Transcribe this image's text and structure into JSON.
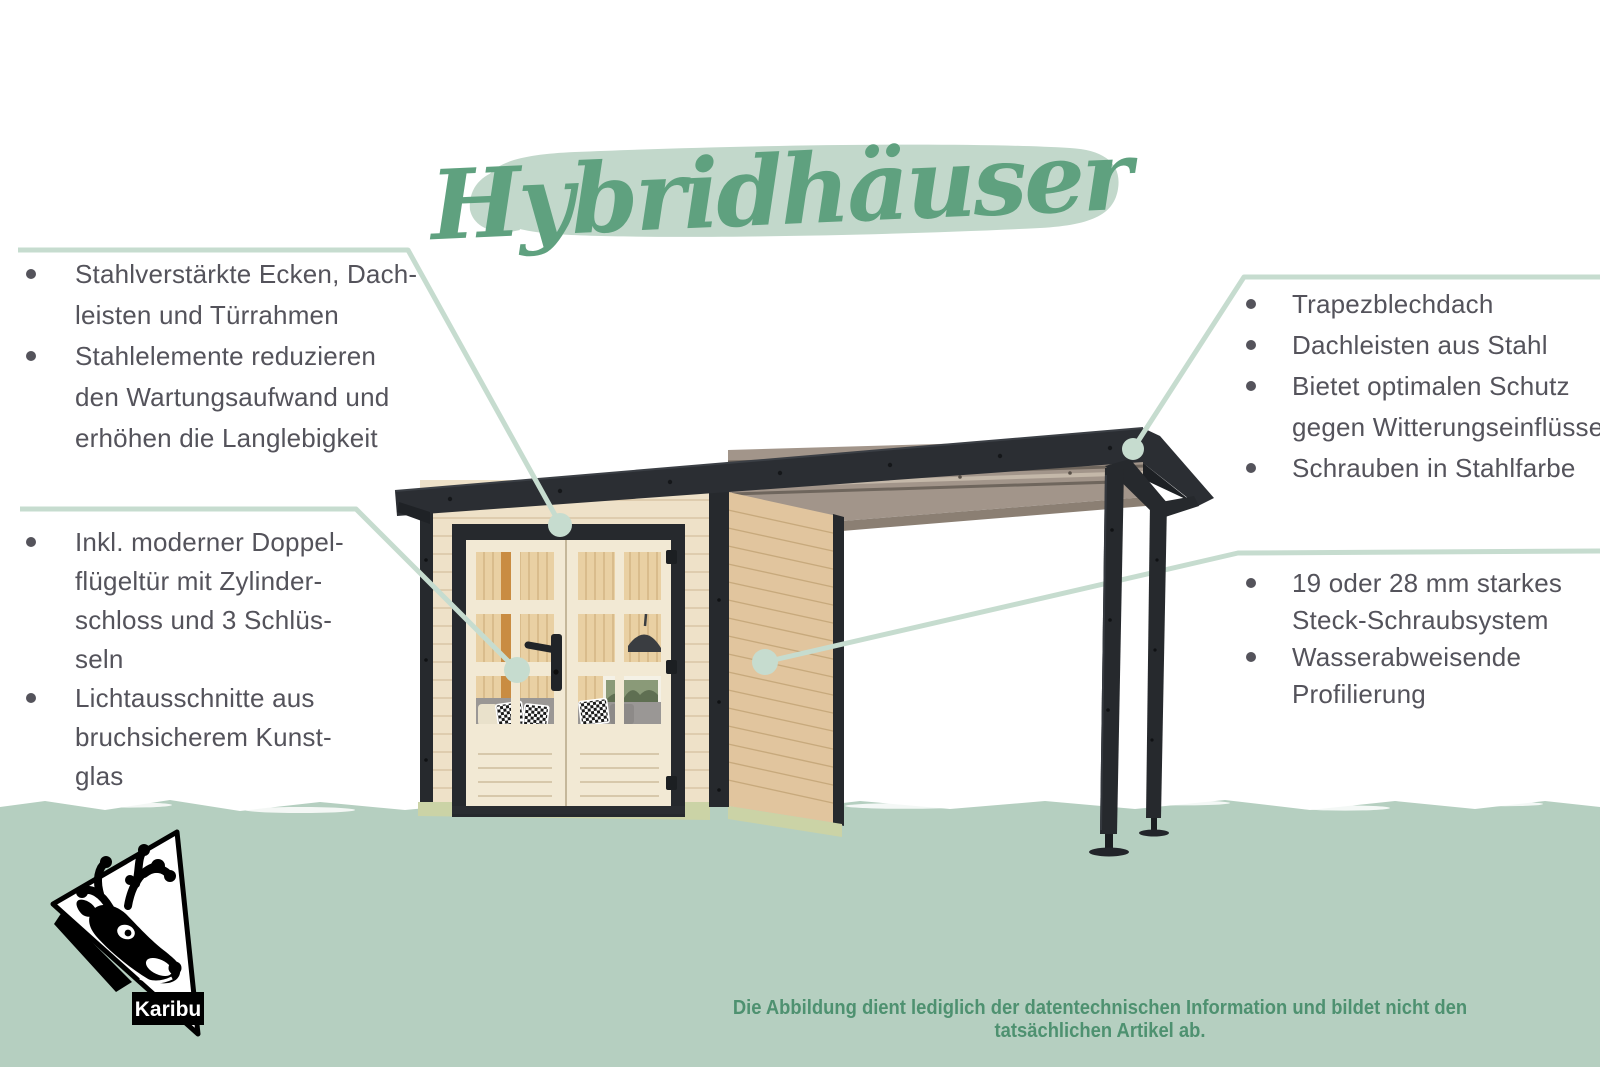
{
  "title": {
    "text": "Hybridhäuser"
  },
  "annotations": {
    "left_top": {
      "lines": [
        {
          "bullet": true,
          "text": "Stahlverstärkte Ecken, Dach-"
        },
        {
          "bullet": false,
          "text": "leisten und Türrahmen"
        },
        {
          "bullet": true,
          "text": "Stahlelemente reduzieren"
        },
        {
          "bullet": false,
          "text": "den Wartungsaufwand und"
        },
        {
          "bullet": false,
          "text": "erhöhen die Langlebigkeit"
        }
      ]
    },
    "left_bottom": {
      "lines": [
        {
          "bullet": true,
          "text": "Inkl. moderner Doppel-"
        },
        {
          "bullet": false,
          "text": "flügeltür mit Zylinder-"
        },
        {
          "bullet": false,
          "text": "schloss und 3 Schlüs-"
        },
        {
          "bullet": false,
          "text": "seln"
        },
        {
          "bullet": true,
          "text": "Lichtausschnitte aus"
        },
        {
          "bullet": false,
          "text": "bruchsicherem Kunst-"
        },
        {
          "bullet": false,
          "text": "glas"
        }
      ]
    },
    "right_top": {
      "lines": [
        {
          "bullet": true,
          "text": "Trapezblechdach"
        },
        {
          "bullet": true,
          "text": "Dachleisten aus Stahl"
        },
        {
          "bullet": true,
          "text": "Bietet optimalen Schutz"
        },
        {
          "bullet": false,
          "text": "gegen Witterungseinflüsse"
        },
        {
          "bullet": true,
          "text": "Schrauben in Stahlfarbe"
        }
      ]
    },
    "right_bottom": {
      "lines": [
        {
          "bullet": true,
          "text": "19 oder 28 mm starkes"
        },
        {
          "bullet": false,
          "text": "Steck-Schraubsystem"
        },
        {
          "bullet": true,
          "text": "Wasserabweisende"
        },
        {
          "bullet": false,
          "text": "Profilierung"
        }
      ]
    }
  },
  "footer": {
    "disclaimer": "Die Abbildung dient lediglich der datentechnischen Information und bildet nicht den tatsächlichen Artikel ab."
  },
  "logo": {
    "label": "Karibu"
  },
  "colors": {
    "title_green": "#66a583",
    "brush_green": "#c2d8cb",
    "band_green": "#b5cfc0",
    "callout_line_green": "#c6dccf",
    "text_gray": "#54535b",
    "disclaimer_green": "#4e9170",
    "anthracite": "#26292d",
    "wood_front": "#eee1c8",
    "wood_side": "#e1c59e",
    "wood_interior": "#e9d0a3",
    "deck_gray": "#a2958a",
    "plinth_green": "#cbd3a6"
  }
}
